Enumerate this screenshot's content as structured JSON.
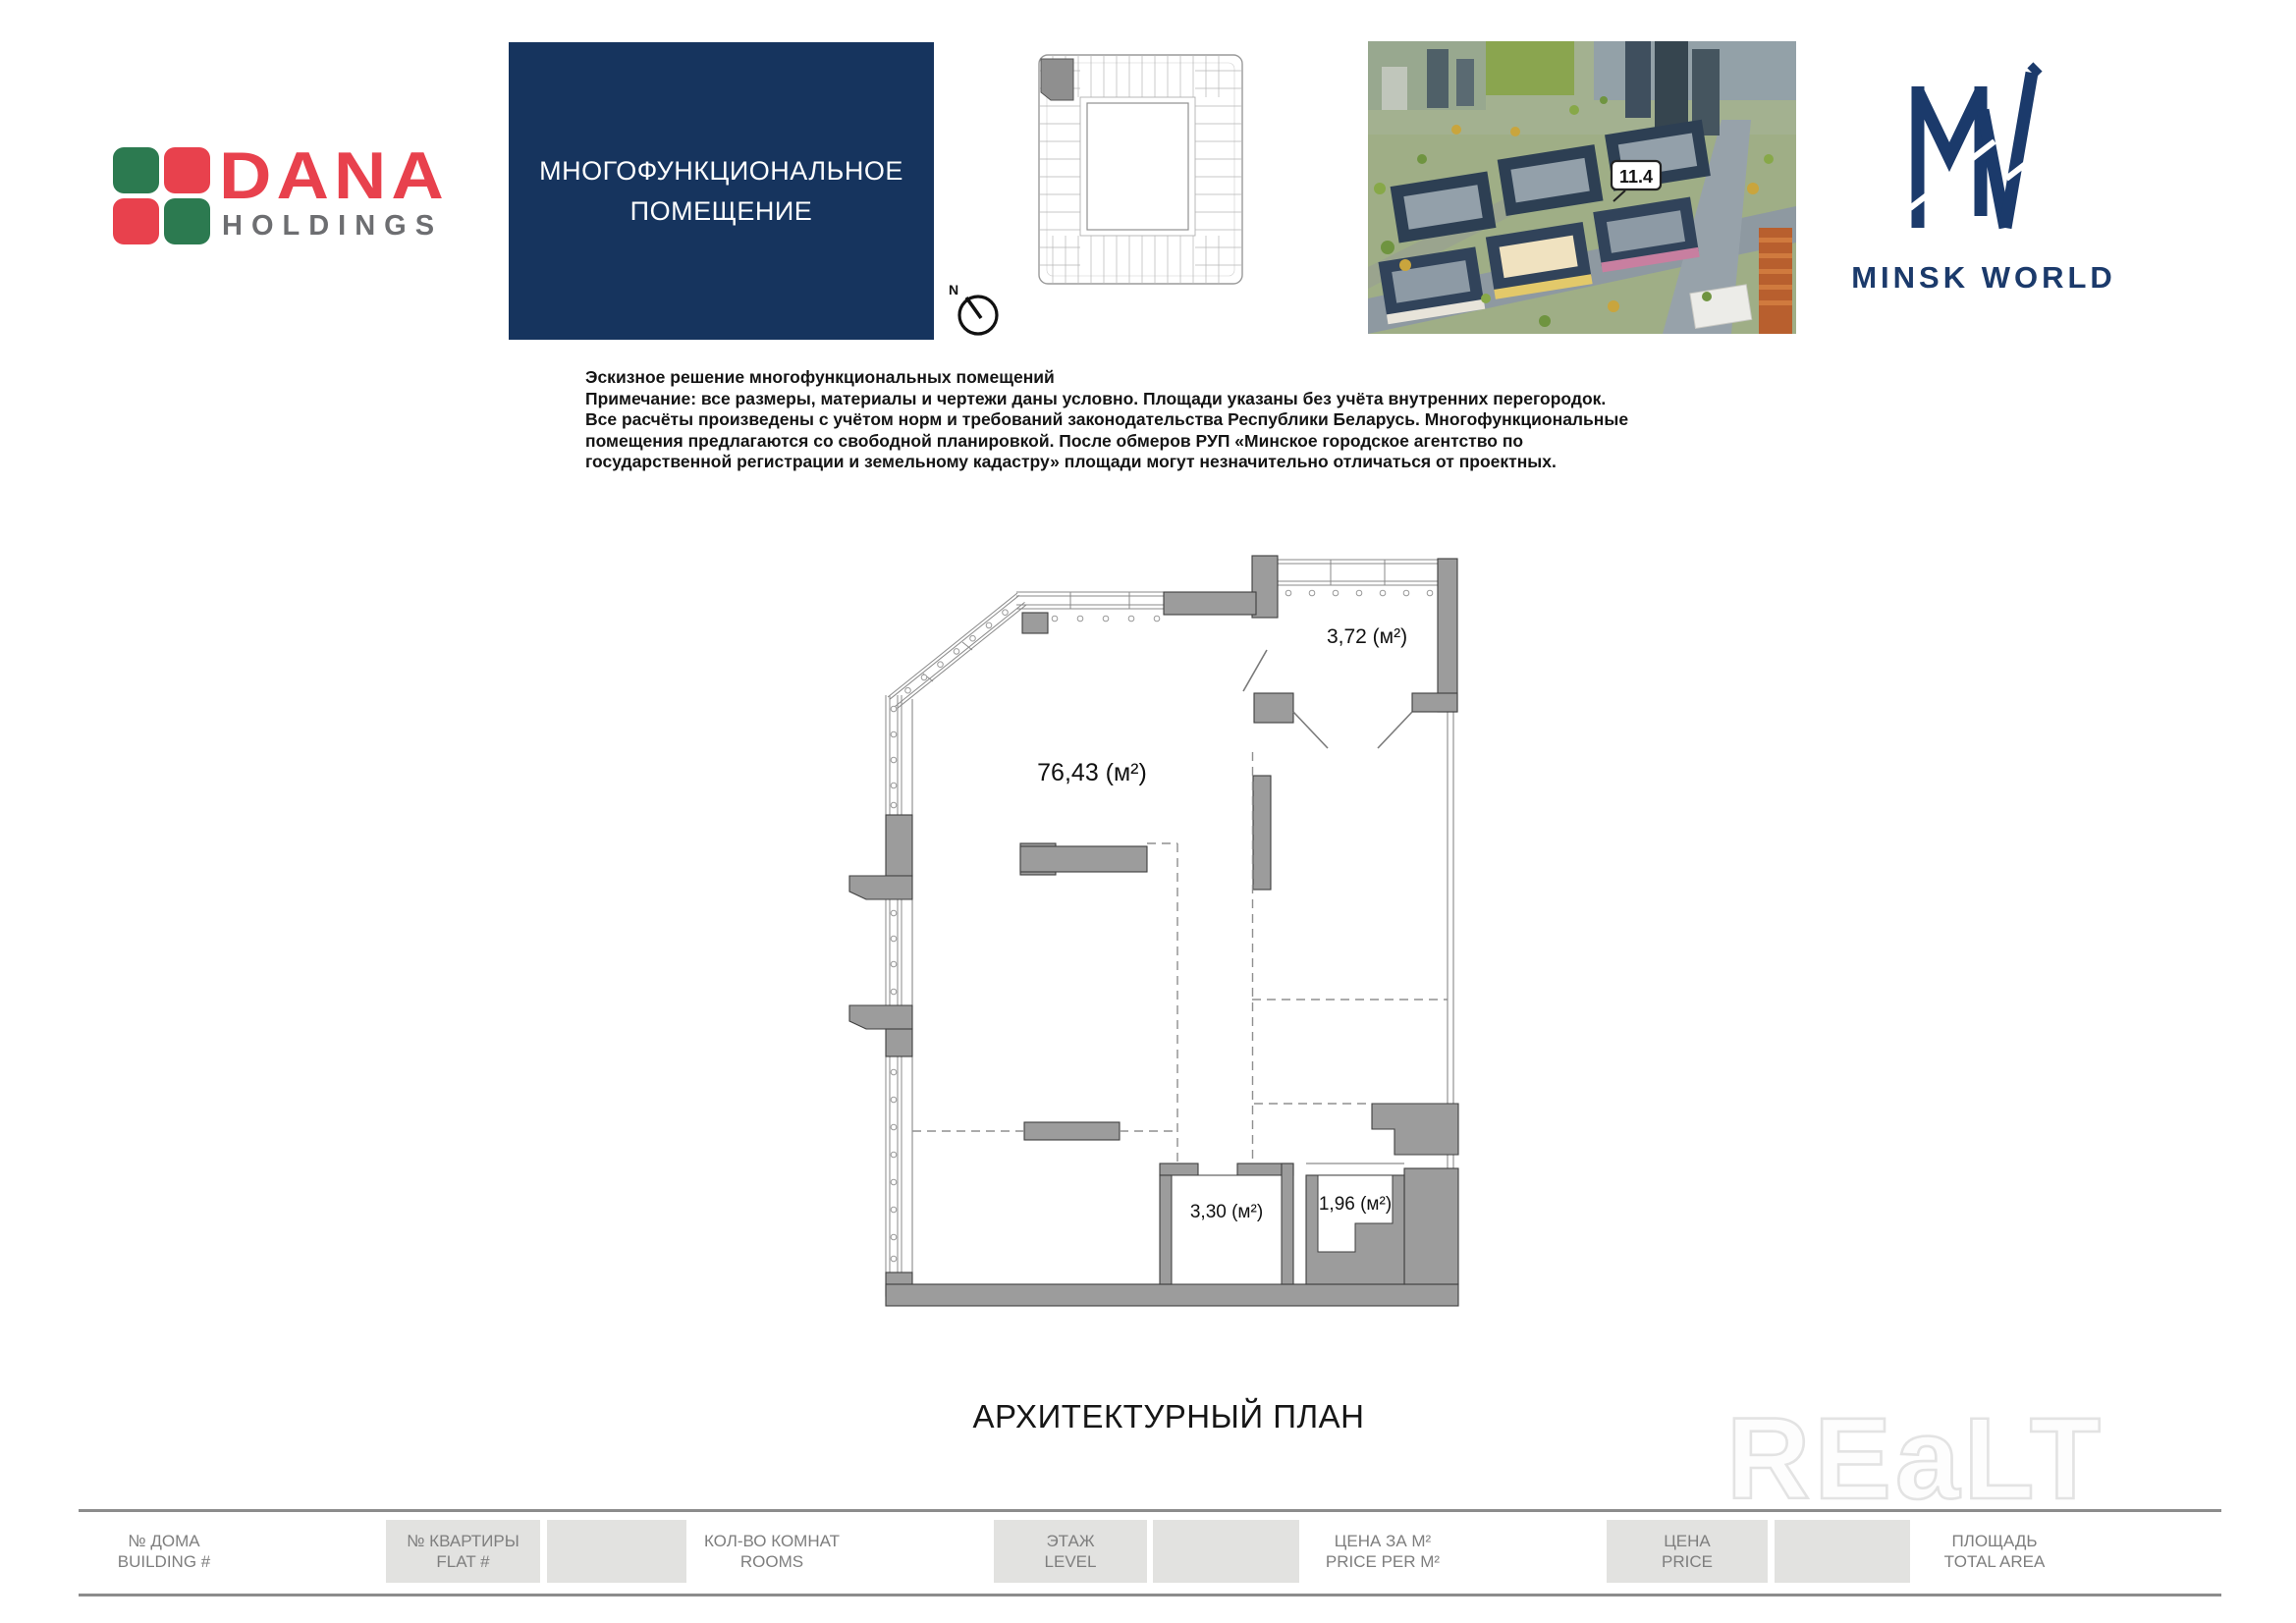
{
  "branding": {
    "dana": {
      "name": "DANA",
      "subtitle": "HOLDINGS",
      "red": "#e8414d",
      "green": "#2c7a50",
      "gray": "#6d6e71"
    },
    "minsk_world": {
      "name": "MINSK WORLD",
      "navy": "#1b3a6b"
    }
  },
  "title_box": {
    "line1": "МНОГОФУНКЦИОНАЛЬНОЕ",
    "line2": "ПОМЕЩЕНИЕ",
    "background": "#16345e"
  },
  "compass": {
    "label": "N"
  },
  "aerial": {
    "callout": "11.4"
  },
  "notes": {
    "lines": [
      "Эскизное решение многофункциональных помещений",
      "Примечание: все размеры, материалы и чертежи даны условно. Площади указаны без учёта внутренних перегородок.",
      "Все расчёты произведены с учётом норм и требований законодательства Республики Беларусь. Многофункциональные",
      "помещения предлагаются со свободной планировкой. После обмеров РУП «Минское городское агентство по",
      "государственной регистрации и земельному кадастру» площади могут незначительно отличаться от проектных."
    ]
  },
  "plan": {
    "areas": {
      "main": "76,43 (м²)",
      "loggia": "3,72 (м²)",
      "room_a": "3,30 (м²)",
      "room_b": "1,96 (м²)"
    },
    "caption": "АРХИТЕКТУРНЫЙ ПЛАН",
    "wall_color": "#9c9c9c",
    "dash_color": "#8f8f8f"
  },
  "watermark": {
    "text": "REaLT"
  },
  "footer": {
    "fields": [
      {
        "ru": "№ ДОМА",
        "en": "BUILDING #"
      },
      {
        "ru": "№ КВАРТИРЫ",
        "en": "FLAT #"
      },
      {
        "ru": "КОЛ-ВО КОМНАТ",
        "en": "ROOMS"
      },
      {
        "ru": "ЭТАЖ",
        "en": "LEVEL"
      },
      {
        "ru": "ЦЕНА ЗА М²",
        "en": "PRICE PER M²"
      },
      {
        "ru": "ЦЕНА",
        "en": "PRICE"
      },
      {
        "ru": "ПЛОЩАДЬ",
        "en": "TOTAL AREA"
      }
    ]
  }
}
